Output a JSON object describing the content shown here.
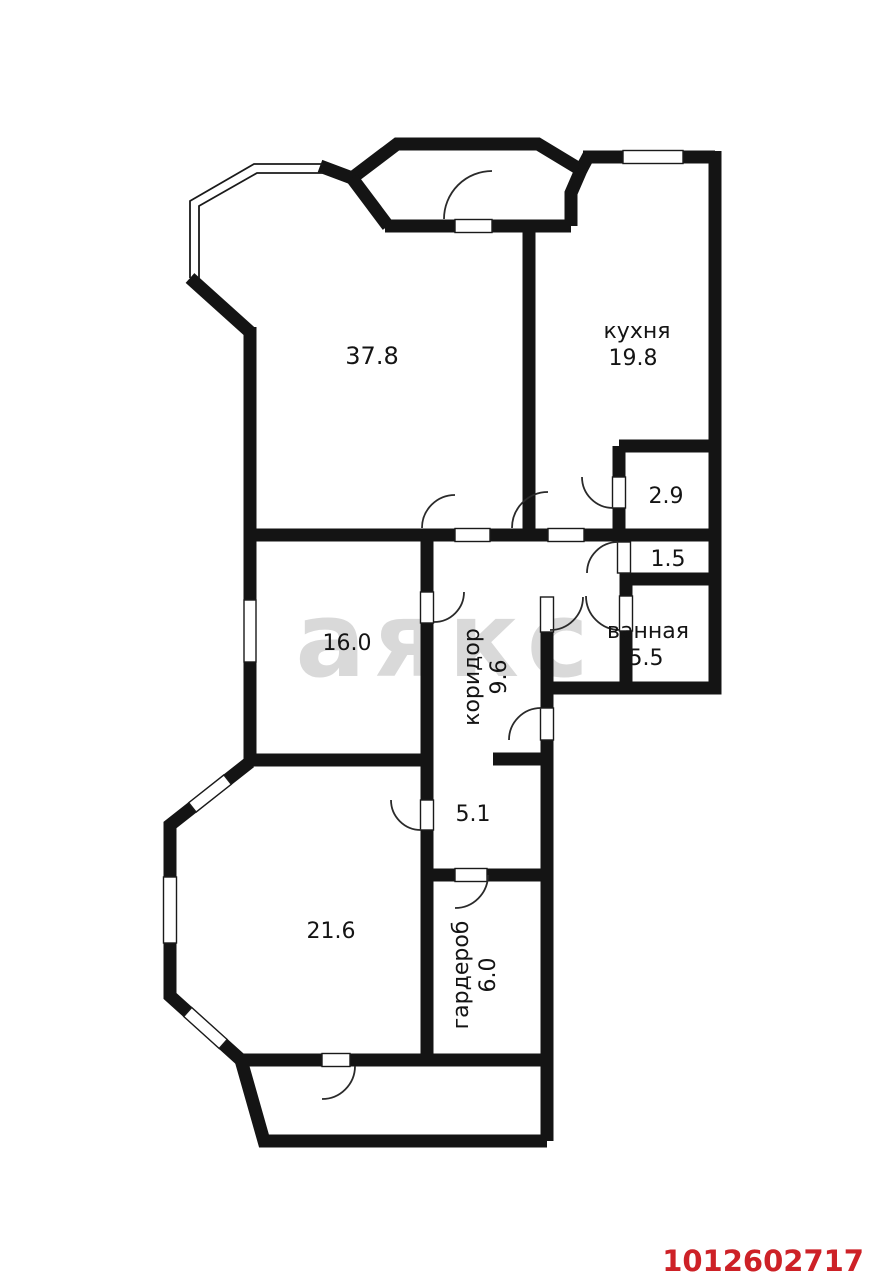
{
  "watermark": {
    "text": "аякс"
  },
  "stamp": {
    "id": "1012602717"
  },
  "colors": {
    "wall": "#141414",
    "watermark": "#d9d9d9",
    "id_red": "#cd2127",
    "paper": "#ffffff"
  },
  "rooms": {
    "living": {
      "area": "37.8"
    },
    "kitchen": {
      "name": "кухня",
      "area": "19.8"
    },
    "pantry": {
      "area": "2.9"
    },
    "wc": {
      "area": "1.5"
    },
    "bathroom": {
      "name": "ванная",
      "area": "5.5"
    },
    "bedroom": {
      "area": "16.0"
    },
    "corridor": {
      "name": "коридор",
      "area": "9.6"
    },
    "hall": {
      "area": "5.1"
    },
    "wardrobe": {
      "name": "гардероб",
      "area": "6.0"
    },
    "bedroom2": {
      "area": "21.6"
    }
  }
}
